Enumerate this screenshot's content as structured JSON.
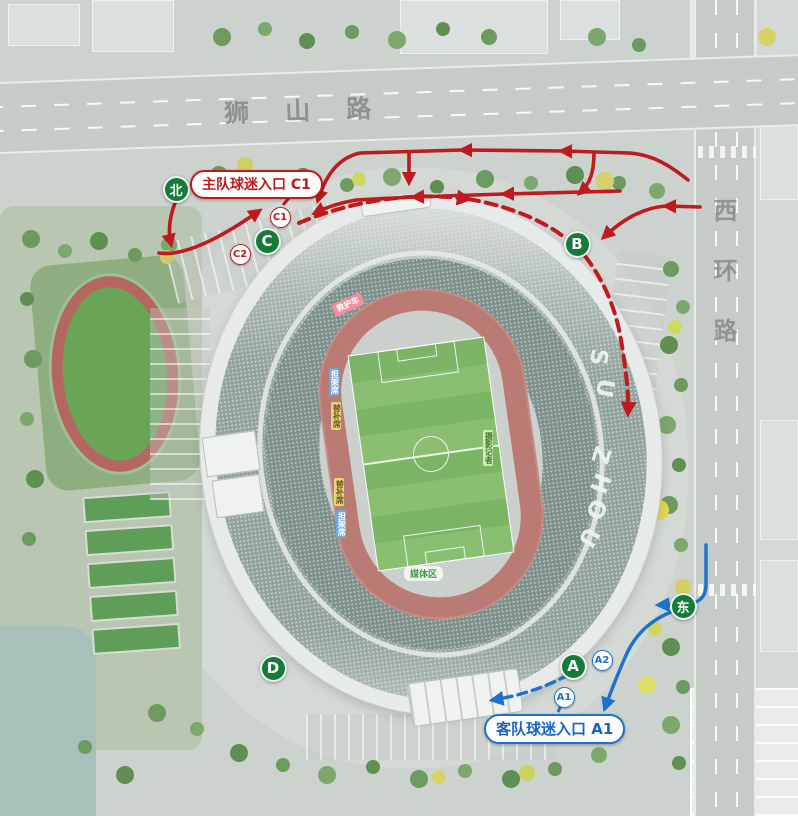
{
  "map": {
    "roads": {
      "top": "狮山路",
      "right": "西环路"
    },
    "compass": {
      "north": "北",
      "east": "东"
    },
    "entrances": {
      "home": {
        "label": "主队球迷入口 C1",
        "color": "#bf1a1e"
      },
      "away": {
        "label": "客队球迷入口 A1",
        "color": "#1d72cc"
      }
    },
    "gates": [
      {
        "label": "A"
      },
      {
        "label": "B"
      },
      {
        "label": "C"
      },
      {
        "label": "D"
      }
    ],
    "sub_gates": [
      {
        "label": "C1",
        "team": "home"
      },
      {
        "label": "C2",
        "team": "home"
      },
      {
        "label": "A1",
        "team": "away"
      },
      {
        "label": "A2",
        "team": "away"
      }
    ],
    "stadium": {
      "brand": [
        "S",
        "U",
        "Z",
        "H",
        "O",
        "U"
      ],
      "field_tags": {
        "ambulance": "救护车",
        "stretcher": "担架席",
        "bench": "替补席",
        "photographers": "摄影记者",
        "media": "媒体区"
      }
    },
    "colors": {
      "home_route": "#bf1a1e",
      "away_route": "#1d72cc",
      "gate_green": "#177a3a"
    }
  }
}
